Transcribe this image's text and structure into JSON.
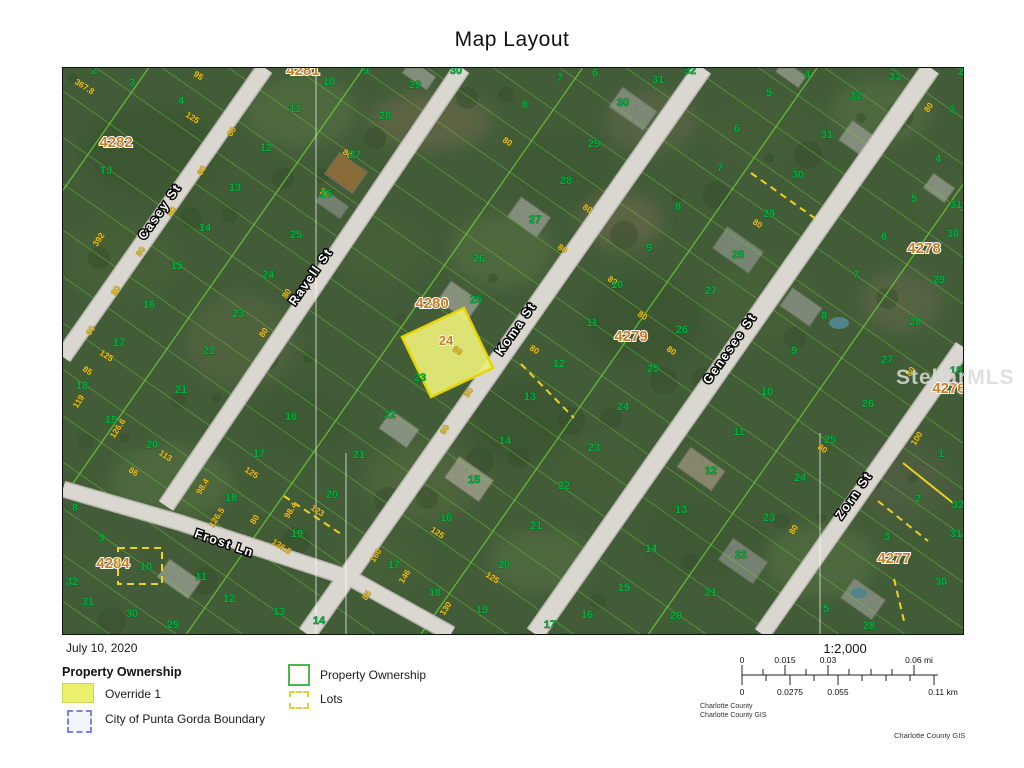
{
  "page_title": "Map Layout",
  "map": {
    "watermark": "StellarMLS",
    "highlight_lot": {
      "label": "24"
    },
    "street_labels": [
      [
        "Casey St",
        162,
        213,
        -55
      ],
      [
        "Ravell St",
        313,
        278,
        -55
      ],
      [
        "Koma St",
        518,
        330,
        -55
      ],
      [
        "Genesee St",
        732,
        350,
        -55
      ],
      [
        "Zorn St",
        856,
        497,
        -55
      ],
      [
        "Frost Ln",
        222,
        546,
        19
      ]
    ],
    "block_labels": [
      [
        "4282",
        115,
        146
      ],
      [
        "4281",
        302,
        74
      ],
      [
        "4280",
        431,
        307
      ],
      [
        "4279",
        630,
        340
      ],
      [
        "4278",
        923,
        252
      ],
      [
        "4276",
        948,
        392
      ],
      [
        "4277",
        893,
        562
      ],
      [
        "4284",
        112,
        567
      ]
    ],
    "lot_labels": [
      [
        "2",
        93,
        73
      ],
      [
        "3",
        131,
        85
      ],
      [
        "4",
        180,
        103
      ],
      [
        "TJ",
        105,
        173
      ],
      [
        "11",
        294,
        111
      ],
      [
        "12",
        265,
        150
      ],
      [
        "13",
        234,
        190
      ],
      [
        "14",
        204,
        230
      ],
      [
        "15",
        176,
        268
      ],
      [
        "16",
        148,
        307
      ],
      [
        "17",
        118,
        345
      ],
      [
        "18",
        81,
        388
      ],
      [
        "19",
        110,
        422
      ],
      [
        "25",
        295,
        237
      ],
      [
        "24",
        267,
        277
      ],
      [
        "23",
        237,
        316
      ],
      [
        "22",
        208,
        353
      ],
      [
        "21",
        180,
        392
      ],
      [
        "20",
        151,
        447
      ],
      [
        "8",
        74,
        510
      ],
      [
        "9",
        101,
        540
      ],
      [
        "10",
        145,
        569
      ],
      [
        "11",
        200,
        579
      ],
      [
        "12",
        228,
        601
      ],
      [
        "13",
        278,
        614
      ],
      [
        "14",
        318,
        623
      ],
      [
        "29",
        172,
        627
      ],
      [
        "30",
        131,
        616
      ],
      [
        "31",
        87,
        604
      ],
      [
        "32",
        71,
        584
      ],
      [
        "16",
        290,
        419
      ],
      [
        "17",
        258,
        456
      ],
      [
        "18",
        230,
        500
      ],
      [
        "19",
        296,
        536
      ],
      [
        "20",
        331,
        497
      ],
      [
        "10",
        328,
        84
      ],
      [
        "9",
        365,
        73
      ],
      [
        "29",
        414,
        87
      ],
      [
        "30",
        455,
        73
      ],
      [
        "28",
        384,
        118
      ],
      [
        "27",
        354,
        157
      ],
      [
        "26",
        325,
        196
      ],
      [
        "25",
        475,
        302
      ],
      [
        "23",
        419,
        380
      ],
      [
        "22",
        389,
        417
      ],
      [
        "21",
        358,
        457
      ],
      [
        "26",
        478,
        261
      ],
      [
        "6",
        594,
        75
      ],
      [
        "7",
        559,
        80
      ],
      [
        "8",
        524,
        107
      ],
      [
        "30",
        622,
        105
      ],
      [
        "29",
        593,
        146
      ],
      [
        "28",
        565,
        183
      ],
      [
        "27",
        534,
        222
      ],
      [
        "31",
        657,
        82
      ],
      [
        "32",
        689,
        73
      ],
      [
        "5",
        768,
        95
      ],
      [
        "6",
        736,
        131
      ],
      [
        "7",
        719,
        170
      ],
      [
        "8",
        677,
        209
      ],
      [
        "9",
        648,
        250
      ],
      [
        "29",
        768,
        216
      ],
      [
        "28",
        737,
        257
      ],
      [
        "10",
        616,
        287
      ],
      [
        "11",
        591,
        325
      ],
      [
        "12",
        558,
        366
      ],
      [
        "13",
        529,
        399
      ],
      [
        "14",
        504,
        443
      ],
      [
        "15",
        473,
        482
      ],
      [
        "16",
        445,
        520
      ],
      [
        "17",
        393,
        567
      ],
      [
        "18",
        434,
        595
      ],
      [
        "19",
        481,
        612
      ],
      [
        "20",
        503,
        567
      ],
      [
        "21",
        535,
        528
      ],
      [
        "22",
        563,
        488
      ],
      [
        "23",
        593,
        450
      ],
      [
        "24",
        622,
        409
      ],
      [
        "25",
        652,
        371
      ],
      [
        "26",
        681,
        332
      ],
      [
        "27",
        710,
        293
      ],
      [
        "9",
        793,
        353
      ],
      [
        "10",
        766,
        394
      ],
      [
        "11",
        738,
        434
      ],
      [
        "12",
        710,
        473
      ],
      [
        "13",
        680,
        512
      ],
      [
        "14",
        650,
        551
      ],
      [
        "15",
        623,
        590
      ],
      [
        "16",
        586,
        617
      ],
      [
        "17",
        549,
        627
      ],
      [
        "6",
        883,
        239
      ],
      [
        "7",
        855,
        277
      ],
      [
        "8",
        823,
        318
      ],
      [
        "30",
        952,
        236
      ],
      [
        "29",
        938,
        282
      ],
      [
        "28",
        914,
        324
      ],
      [
        "27",
        886,
        362
      ],
      [
        "26",
        867,
        406
      ],
      [
        "18",
        955,
        373
      ],
      [
        "4",
        806,
        77
      ],
      [
        "33",
        894,
        79
      ],
      [
        "32",
        855,
        98
      ],
      [
        "31",
        826,
        137
      ],
      [
        "30",
        797,
        177
      ],
      [
        "2",
        960,
        74
      ],
      [
        "3",
        951,
        112
      ],
      [
        "4",
        937,
        161
      ],
      [
        "5",
        913,
        201
      ],
      [
        "31",
        955,
        207
      ],
      [
        "25",
        829,
        442
      ],
      [
        "24",
        799,
        480
      ],
      [
        "23",
        768,
        520
      ],
      [
        "22",
        740,
        557
      ],
      [
        "21",
        710,
        595
      ],
      [
        "20",
        675,
        618
      ],
      [
        "1",
        940,
        456
      ],
      [
        "2",
        917,
        501
      ],
      [
        "3",
        886,
        539
      ],
      [
        "32",
        957,
        507
      ],
      [
        "31",
        955,
        536
      ],
      [
        "30",
        940,
        584
      ],
      [
        "5",
        825,
        611
      ],
      [
        "28",
        868,
        628
      ]
    ],
    "dim_labels": [
      [
        "367.8",
        82,
        88,
        33
      ],
      [
        "95",
        196,
        77,
        33
      ],
      [
        "125",
        190,
        119,
        33
      ],
      [
        "392",
        100,
        240,
        -57
      ],
      [
        "80",
        233,
        132,
        -57
      ],
      [
        "80",
        203,
        171,
        -57
      ],
      [
        "80",
        173,
        212,
        -57
      ],
      [
        "80",
        142,
        252,
        -57
      ],
      [
        "80",
        117,
        291,
        -57
      ],
      [
        "80",
        92,
        331,
        -57
      ],
      [
        "125",
        104,
        357,
        33
      ],
      [
        "85",
        85,
        372,
        33
      ],
      [
        "119",
        80,
        402,
        -57
      ],
      [
        "126.6",
        119,
        429,
        -57
      ],
      [
        "113",
        163,
        457,
        33
      ],
      [
        "86",
        131,
        473,
        33
      ],
      [
        "125",
        249,
        474,
        33
      ],
      [
        "98.4",
        204,
        487,
        -57
      ],
      [
        "126.5",
        218,
        518,
        -57
      ],
      [
        "80",
        256,
        520,
        -57
      ],
      [
        "98.4",
        292,
        511,
        -57
      ],
      [
        "123",
        315,
        512,
        33
      ],
      [
        "126.5",
        279,
        548,
        33
      ],
      [
        "80",
        288,
        294,
        -57
      ],
      [
        "80",
        265,
        333,
        -57
      ],
      [
        "80",
        345,
        155,
        33
      ],
      [
        "80",
        322,
        194,
        33
      ],
      [
        "160",
        377,
        556,
        -57
      ],
      [
        "146",
        406,
        577,
        -57
      ],
      [
        "85",
        368,
        596,
        -57
      ],
      [
        "130",
        447,
        609,
        -57
      ],
      [
        "125",
        435,
        534,
        33
      ],
      [
        "125",
        490,
        579,
        33
      ],
      [
        "80",
        455,
        352,
        33
      ],
      [
        "80",
        470,
        393,
        -57
      ],
      [
        "80",
        446,
        430,
        -57
      ],
      [
        "80",
        532,
        351,
        33
      ],
      [
        "80",
        505,
        143,
        33
      ],
      [
        "80",
        560,
        250,
        33
      ],
      [
        "80",
        585,
        210,
        33
      ],
      [
        "80",
        610,
        282,
        33
      ],
      [
        "80",
        640,
        317,
        33
      ],
      [
        "80",
        669,
        352,
        33
      ],
      [
        "80",
        912,
        372,
        -57
      ],
      [
        "100",
        918,
        439,
        -57
      ],
      [
        "80",
        930,
        108,
        -57
      ],
      [
        "80",
        820,
        450,
        33
      ],
      [
        "80",
        795,
        530,
        -57
      ],
      [
        "80",
        755,
        225,
        33
      ]
    ]
  },
  "footer": {
    "date": "July 10, 2020",
    "legend_title": "Property Ownership",
    "legend": {
      "override": "Override 1",
      "boundary": "City of Punta Gorda Boundary",
      "ownership": "Property Ownership",
      "lots": "Lots"
    },
    "scale": {
      "ratio": "1:2,000",
      "mi": [
        "0",
        "0.015",
        "0.03",
        "0.06 mi"
      ],
      "km": [
        "0",
        "0.0275",
        "0.055",
        "0.11 km"
      ]
    },
    "credits": [
      "Charlotte County",
      "Charlotte County GIS"
    ],
    "attribution": "Charlotte County GIS"
  },
  "colors": {
    "parcel_line": "#6fcf3a",
    "road": "#d9d7cf",
    "lot_number": "#00b33c",
    "dimension": "#edbf1e",
    "block_number": "#c87d28",
    "street_label": "#ffffff",
    "highlight_fill": "#e9ef78",
    "highlight_border": "#e8d400",
    "override_swatch": "#ebf06a",
    "boundary_swatch": "#7b86d8",
    "ownership_swatch": "#4db848",
    "lots_swatch": "#e3cf3f",
    "vegetation": "#42603a"
  }
}
